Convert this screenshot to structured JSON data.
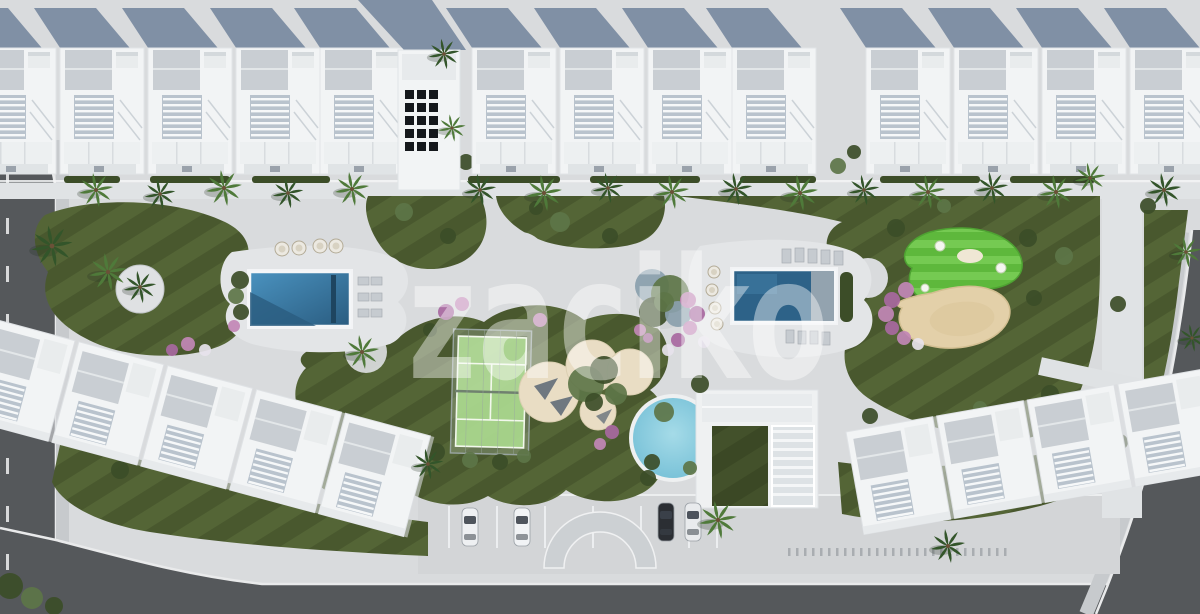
{
  "scene": {
    "type": "aerial-3d-architectural-render",
    "subject": "Top-down masterplan render of a white residential apartment complex with landscaped central garden",
    "watermark_text": "zaciko"
  },
  "palette": {
    "concrete": "#d9dbdd",
    "deck": "#e3e5e7",
    "walkway": "#e0e3e5",
    "building_white": "#f2f4f5",
    "roof_grey": "#c9ced3",
    "balcony_slat": "#b9c3cd",
    "cast_shadow": "#76879f",
    "grass": "#49582e",
    "grass_stripe": "#5c6e3c",
    "putting_green": "#5eb83c",
    "putting_stripe": "#7bce57",
    "padel_court": "#a9d88d",
    "pool_left": "#4a92bf",
    "pool_left_deep": "#2a5c80",
    "pool_right": "#2d6288",
    "round_pool": "#6fbcd4",
    "sand": "#e3d0a9",
    "play_sand": "#e9ddc4",
    "road": "#55585b",
    "sidewalk": "#c7cacd",
    "curb": "#e9eaeb",
    "hedge": "#3c4d28",
    "palm": "#33552a",
    "palm_light": "#4f7a3a",
    "flower_pink": "#c287b6",
    "flower_violet": "#a868a0",
    "flower_white": "#e7e3ec",
    "tree_olive": "#5d7548",
    "tree_blue": "#8aa0ad",
    "shade_sail": "#6f7880",
    "solar_panel": "#15181c"
  },
  "site": {
    "top_building_clusters": 3,
    "bottom_building_rows": 2,
    "rect_pools": 2,
    "round_pools": 1,
    "padel_courts": 1,
    "putting_green_holes": 3,
    "entrance_arches": 1,
    "parked_cars": 4
  },
  "parking": {
    "cars": [
      {
        "x": 470,
        "y": 527,
        "color": "#eef0f2"
      },
      {
        "x": 522,
        "y": 527,
        "color": "#f1f3f5"
      },
      {
        "x": 666,
        "y": 522,
        "color": "#2b2e33"
      },
      {
        "x": 693,
        "y": 522,
        "color": "#e9ebed"
      }
    ]
  }
}
